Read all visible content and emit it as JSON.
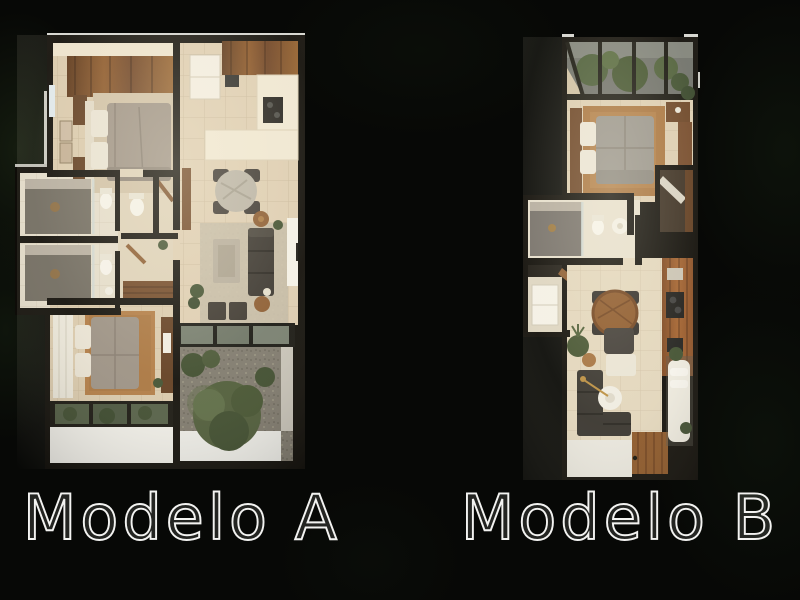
{
  "page": {
    "background_color": "#070806",
    "description": "Two top-down rendered apartment floor plans on a dark foliage background"
  },
  "plans": [
    {
      "id": "modelo-a",
      "label": "Modelo A",
      "features": [
        "bedroom-1",
        "kitchen",
        "dining-table",
        "living-sofa",
        "two-bathrooms",
        "bedroom-2",
        "garden-patio",
        "skylight",
        "terrace"
      ]
    },
    {
      "id": "modelo-b",
      "label": "Modelo B",
      "features": [
        "skylight-garden-view",
        "bedroom",
        "bathroom",
        "wardrobe",
        "kitchen-strip",
        "dining-table",
        "living-sofa",
        "wood-deck",
        "lounger"
      ]
    }
  ],
  "colors": {
    "background": "#070806",
    "wall_black": "#0e0c08",
    "tile_floor": "#dccdb2",
    "tile_light": "#efe7d3",
    "wood_dark": "#6b4426",
    "wood_warm": "#8a5527",
    "rug_rust": "#a8743f",
    "duvet_gray": "#98948c",
    "sofa_charcoal": "#35322d",
    "foliage_green": "#42512f",
    "gravel_gray": "#7d786d",
    "label_text": "#f3f3f1"
  }
}
